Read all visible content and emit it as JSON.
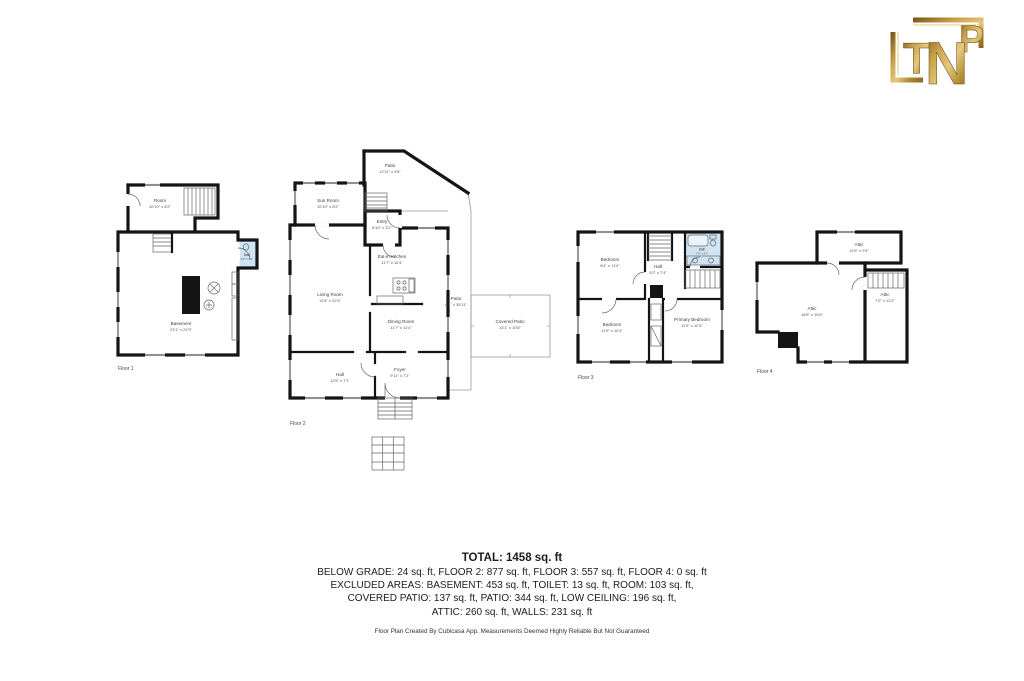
{
  "logo": {
    "letters": {
      "t": "T",
      "n": "N",
      "p": "P"
    }
  },
  "floors": [
    {
      "label": "Floor 1",
      "rooms": [
        {
          "name": "Room",
          "dims": "10'10\" x 8'2\""
        },
        {
          "name": "Bath",
          "dims": "3'4\" x 4'1\""
        },
        {
          "name": "Basement",
          "dims": "23'1\" x 21'9\""
        }
      ]
    },
    {
      "label": "Floor 2",
      "rooms": [
        {
          "name": "Patio",
          "dims": "12'11\" x 9'8\""
        },
        {
          "name": "Sun Room",
          "dims": "10'10\" x 8'2\""
        },
        {
          "name": "Entry",
          "dims": "8'10\" x 3'2\""
        },
        {
          "name": "Eat-in Kitchen",
          "dims": "11'7\" x 10'4\""
        },
        {
          "name": "Living Room",
          "dims": "13'4\" x 22'4\""
        },
        {
          "name": "Dining Room",
          "dims": "11'7\" x 11'4\""
        },
        {
          "name": "Patio",
          "dims": "6'1\" x 39'11\""
        },
        {
          "name": "Covered Patio",
          "dims": "13'1\" x 10'6\""
        },
        {
          "name": "Hall",
          "dims": "12'5\" x 7'1\""
        },
        {
          "name": "Foyer",
          "dims": "9'11\" x 7'2\""
        }
      ]
    },
    {
      "label": "Floor 3",
      "rooms": [
        {
          "name": "Bedroom",
          "dims": "8'4\" x 11'4\""
        },
        {
          "name": "Hall",
          "dims": "9'2\" x 7'4\""
        },
        {
          "name": "Bath",
          "dims": "7'9\" x 5'3\""
        },
        {
          "name": "Bedroom",
          "dims": "11'9\" x 10'4\""
        },
        {
          "name": "Primary Bedroom",
          "dims": "11'9\" x 12'4\""
        }
      ]
    },
    {
      "label": "Floor 4",
      "rooms": [
        {
          "name": "Attic",
          "dims": "14'5\" x 9'4\""
        },
        {
          "name": "Attic",
          "dims": "18'8\" x 16'6\""
        },
        {
          "name": "Attic",
          "dims": "7'0\" x 12'2\""
        }
      ]
    }
  ],
  "summary": {
    "total": "TOTAL: 1458 sq. ft",
    "lines": [
      "BELOW GRADE: 24 sq. ft, FLOOR 2: 877 sq. ft, FLOOR 3: 557 sq. ft, FLOOR 4: 0 sq. ft",
      "EXCLUDED AREAS: BASEMENT: 453 sq. ft, TOILET: 13 sq. ft, ROOM: 103 sq. ft,",
      "COVERED PATIO: 137 sq. ft, PATIO: 344 sq. ft, LOW CEILING: 196 sq. ft,",
      "ATTIC: 260 sq. ft, WALLS: 231 sq. ft"
    ],
    "disclaimer": "Floor Plan Created By Cubicasa App. Measurements Deemed Highly Reliable But Not Guaranteed"
  },
  "colors": {
    "wall": "#141414",
    "bath_fill": "#cfe4f2",
    "gold": "#b8923d",
    "background": "#ffffff"
  }
}
